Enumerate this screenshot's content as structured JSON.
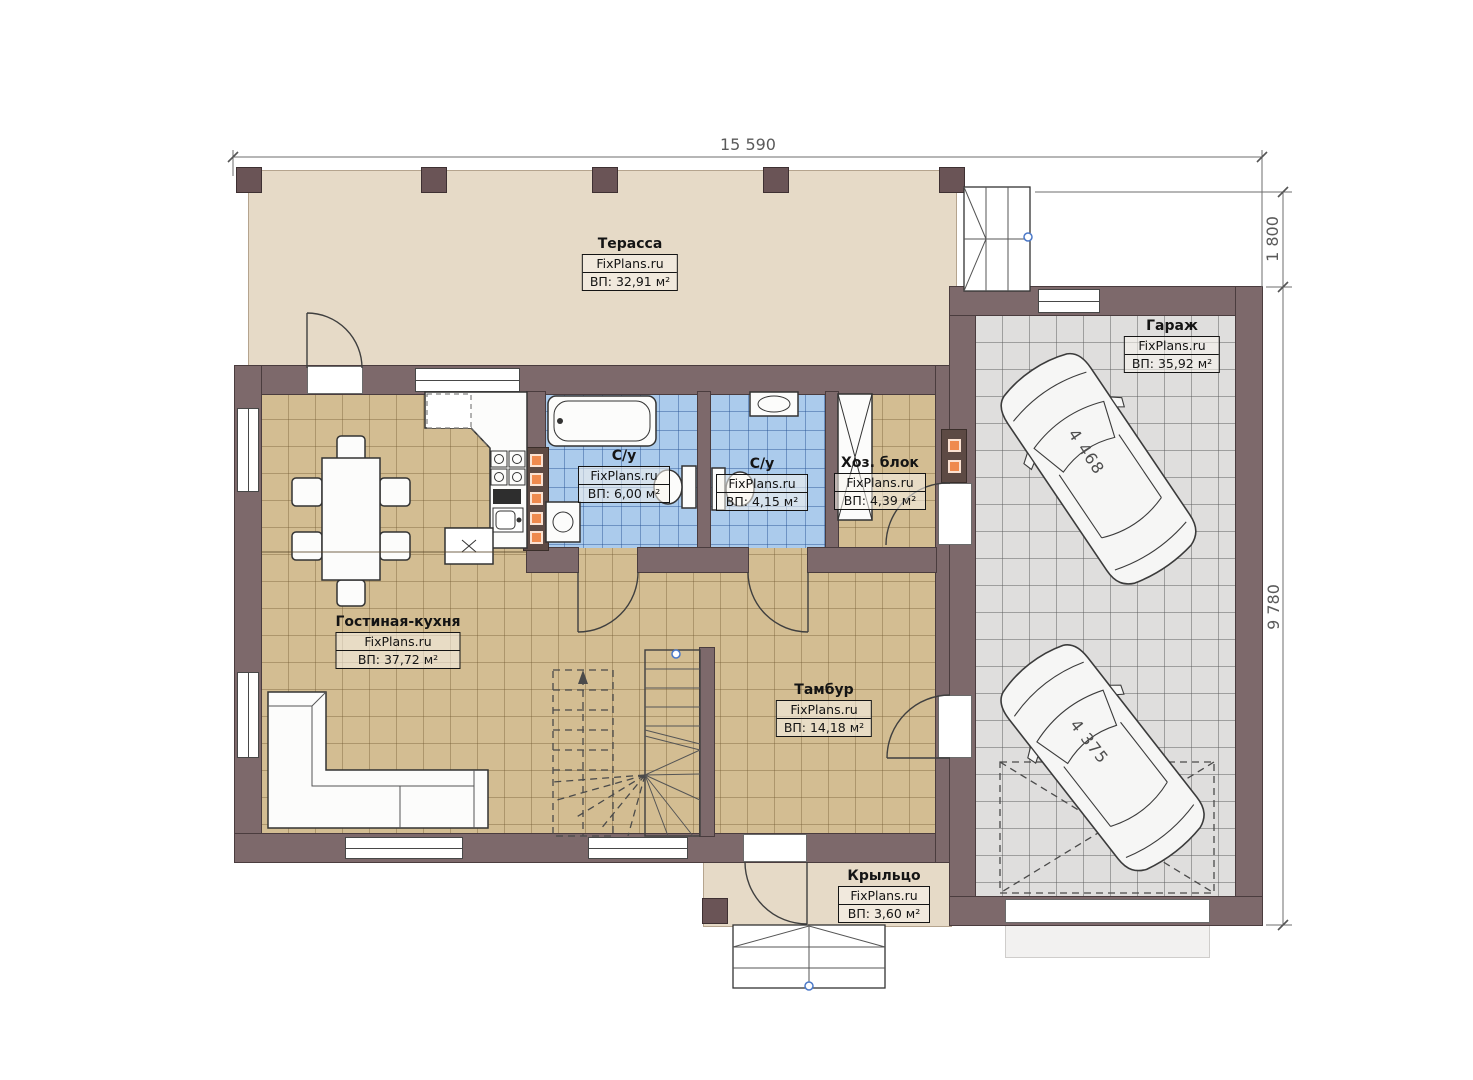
{
  "plan": {
    "brand": "FixPlans.ru",
    "dimensions": {
      "top_width": "15 590",
      "right_upper": "1 800",
      "right_lower": "9 780"
    },
    "rooms": [
      {
        "key": "terrace",
        "name": "Терасса",
        "brand": "FixPlans.ru",
        "area": "ВП: 32,91 м²"
      },
      {
        "key": "garage",
        "name": "Гараж",
        "brand": "FixPlans.ru",
        "area": "ВП: 35,92 м²"
      },
      {
        "key": "bathroom-1",
        "name": "С/у",
        "brand": "FixPlans.ru",
        "area": "ВП: 6,00 м²"
      },
      {
        "key": "bathroom-2",
        "name": "С/у",
        "brand": "FixPlans.ru",
        "area": "ВП: 4,15 м²"
      },
      {
        "key": "utility",
        "name": "Хоз. блок",
        "brand": "FixPlans.ru",
        "area": "ВП: 4,39 м²"
      },
      {
        "key": "living-kitchen",
        "name": "Гостиная-кухня",
        "brand": "FixPlans.ru",
        "area": "ВП: 37,72 м²"
      },
      {
        "key": "vestibule",
        "name": "Тамбур",
        "brand": "FixPlans.ru",
        "area": "ВП: 14,18 м²"
      },
      {
        "key": "porch",
        "name": "Крыльцо",
        "brand": "FixPlans.ru",
        "area": "ВП: 3,60 м²"
      }
    ],
    "cars": [
      {
        "length": "4 468"
      },
      {
        "length": "4 375"
      }
    ],
    "colors": {
      "wall": "#7d696b",
      "wallEdge": "#4a3c3e",
      "tan": "#d3bd92",
      "blue": "#abcbec",
      "gray": "#dfdedd",
      "beige": "#e6dac7",
      "vent": "#ef8a4e",
      "dim": "#6e6e6e"
    }
  }
}
